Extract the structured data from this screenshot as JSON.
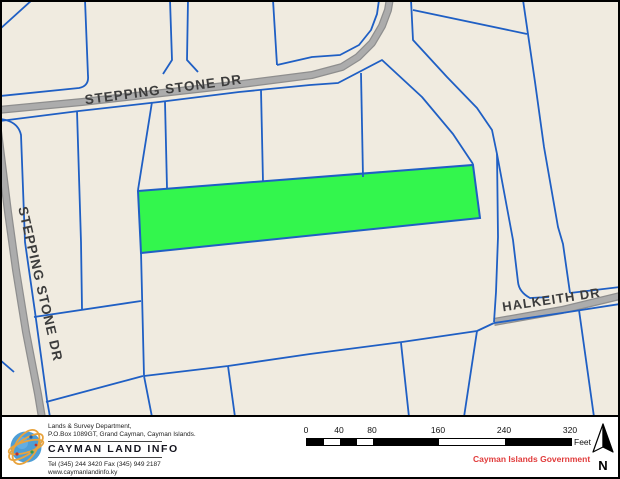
{
  "map": {
    "background_color": "#f0ebe0",
    "parcel_line_color": "#1f5fc4",
    "road_color": "#acacac",
    "road_casing_color": "#8e8e8e",
    "highlight_color": "#33f64d",
    "labels": {
      "stepping_stone_horizontal": "STEPPING STONE DR",
      "stepping_stone_vertical": "STEPPING STONE DR",
      "halkeith": "HALKEITH DR"
    }
  },
  "footer": {
    "dept_line1": "Lands & Survey Department,",
    "dept_line2": "P.O.Box 1089GT, Grand Cayman, Cayman Islands.",
    "brand": "CAYMAN LAND INFO",
    "tel_fax": "Tel (345) 244 3420   Fax (345) 949 2187",
    "website": "www.caymanlandinfo.ky",
    "government": "Cayman Islands Government",
    "government_color": "#e13b3b",
    "north_label": "N",
    "scalebar": {
      "ticks": [
        "0",
        "40",
        "80",
        "160",
        "240",
        "320"
      ],
      "unit": "Feet"
    }
  }
}
